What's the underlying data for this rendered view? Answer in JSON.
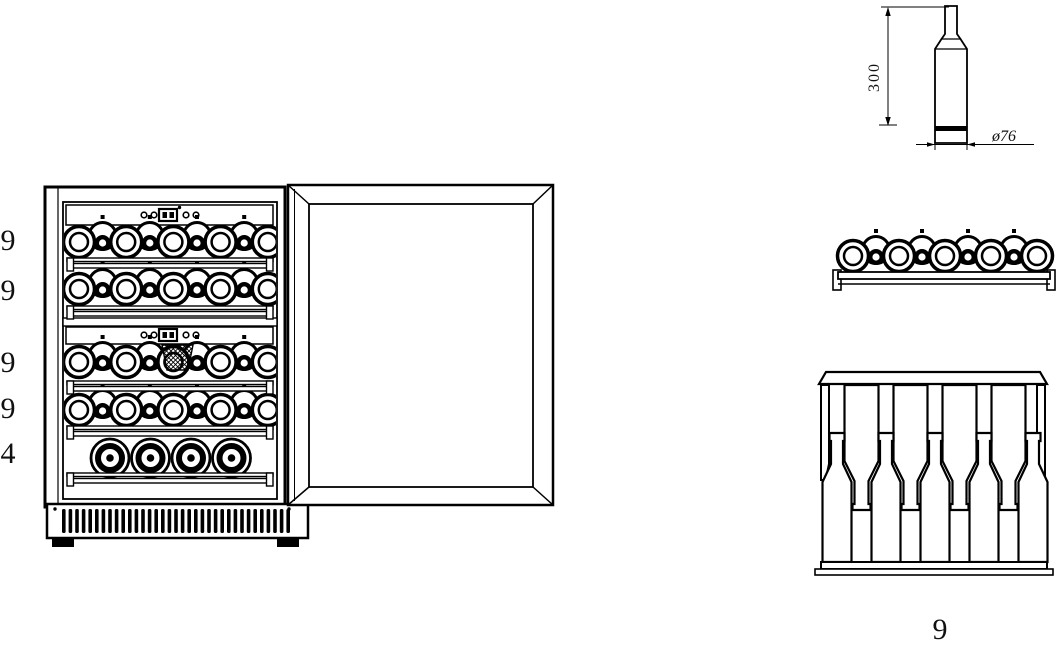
{
  "front_view": {
    "row_labels": [
      "9",
      "9",
      "9",
      "9",
      "4"
    ]
  },
  "bottle_detail": {
    "height_label": "300",
    "diameter_label": "ø76"
  },
  "bottom_shelf": {
    "count_label": "9"
  },
  "colors": {
    "line": "#000000",
    "background": "#ffffff"
  }
}
